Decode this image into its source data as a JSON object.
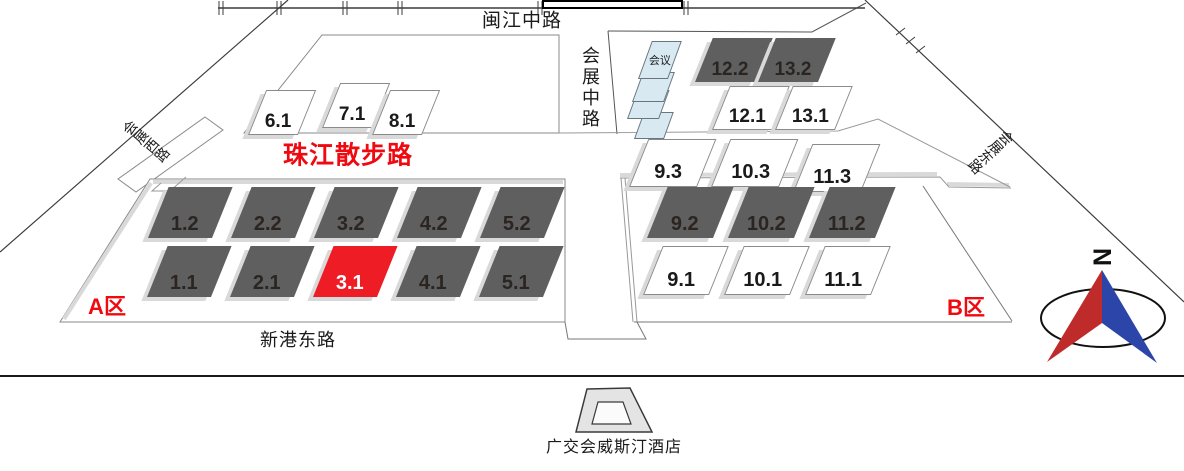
{
  "map": {
    "title": "Canton Fair Complex map",
    "roads": {
      "minjiang_middle": "闽江中路",
      "huizhan_middle": "会展中路",
      "huizhan_west": "会展西路",
      "huizhan_east": "会展东路",
      "zhujiang_promenade": "珠江散步路",
      "xingang_east": "新港东路"
    },
    "zones": {
      "a": "A区",
      "b": "B区"
    },
    "conference": "会议",
    "hotel": "广交会威斯汀酒店",
    "compass_n": "N",
    "highlighted_hall": "3.1",
    "halls": {
      "a_upper": [
        "1.2",
        "2.2",
        "3.2",
        "4.2",
        "5.2"
      ],
      "a_lower": [
        "1.1",
        "2.1",
        "3.1",
        "4.1",
        "5.1"
      ],
      "a_north": [
        "6.1",
        "7.1",
        "8.1"
      ],
      "b_row3": [
        "9.3",
        "10.3",
        "11.3"
      ],
      "b_row2": [
        "9.2",
        "10.2",
        "11.2"
      ],
      "b_row1": [
        "9.1",
        "10.1",
        "11.1"
      ],
      "b_upper2": [
        "12.2",
        "13.2"
      ],
      "b_upper1": [
        "12.1",
        "13.1"
      ]
    },
    "colors": {
      "hall_dark": "#5f5f5f",
      "hall_light": "#ffffff",
      "hall_highlight": "#ee1c25",
      "conference_fill": "#d8e9f2",
      "label_red": "#ee0a10",
      "compass_red": "#bf2b2b",
      "compass_blue": "#2b46a8"
    }
  }
}
